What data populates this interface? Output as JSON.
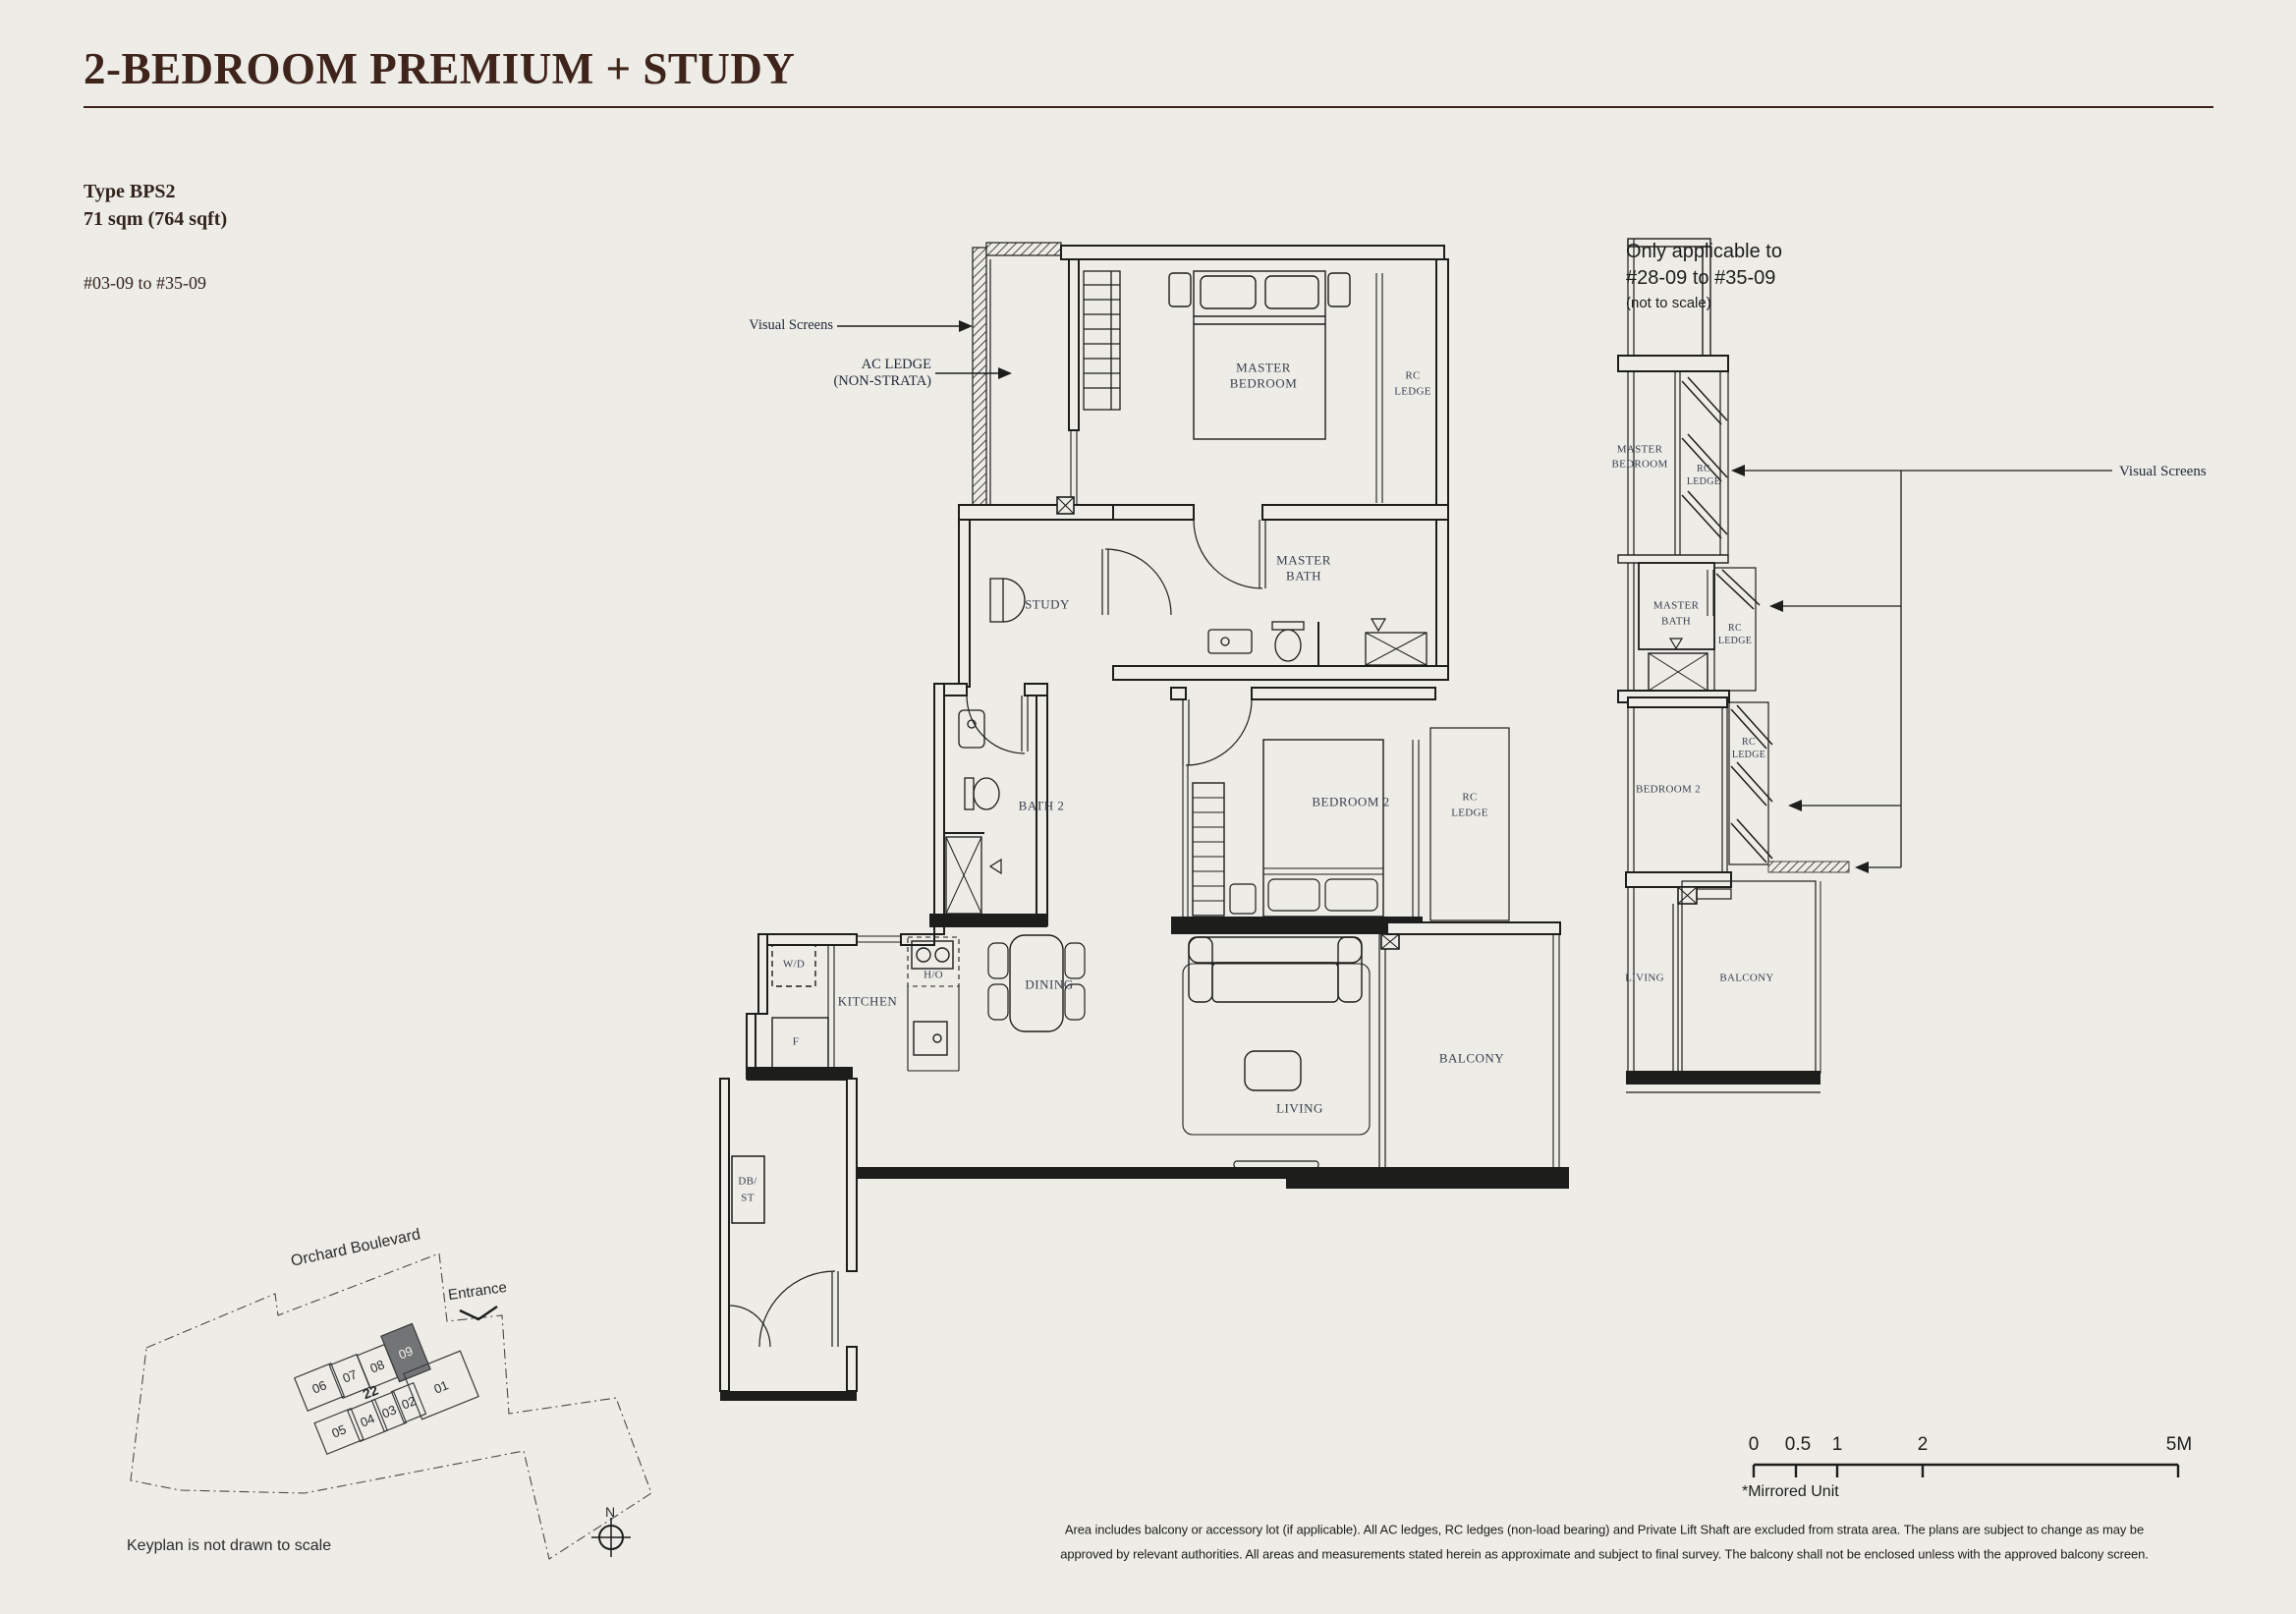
{
  "title": "2-BEDROOM PREMIUM + STUDY",
  "unit_info": {
    "type_label": "Type BPS2",
    "area": "71 sqm (764 sqft)",
    "stack_range": "#03-09 to #35-09"
  },
  "applicability": {
    "line1": "Only applicable to",
    "line2": "#28-09 to #35-09",
    "line3": "(not to scale)"
  },
  "callouts": {
    "visual_screens": "Visual Screens",
    "ac_ledge": "AC LEDGE",
    "ac_ledge_note": "(NON-STRATA)"
  },
  "rooms": {
    "master": "MASTER",
    "bedroom": "BEDROOM",
    "bath": "BATH",
    "rc": "RC",
    "ledge": "LEDGE",
    "study": "STUDY",
    "bath2": "BATH 2",
    "bedroom2": "BEDROOM 2",
    "wd": "W/D",
    "kitchen": "KITCHEN",
    "ho": "H/O",
    "fridge": "F",
    "dining": "DINING",
    "living": "LIVING",
    "balcony": "BALCONY",
    "db": "DB/",
    "st": "ST"
  },
  "keyplan": {
    "road": "Orchard Boulevard",
    "entrance": "Entrance",
    "north": "N",
    "note": "Keyplan is not drawn to scale",
    "units": {
      "u06": "06",
      "u07": "07",
      "u08": "08",
      "u09": "09",
      "u22": "22",
      "u01": "01",
      "u05": "05",
      "u04": "04",
      "u03": "03",
      "u02": "02"
    }
  },
  "scalebar": {
    "t0": "0",
    "t05": "0.5",
    "t1": "1",
    "t2": "2",
    "t5": "5M",
    "mirrored": "*Mirrored Unit"
  },
  "disclaimer": {
    "line1": "Area includes balcony or accessory lot (if applicable). All AC ledges, RC ledges (non-load bearing) and Private Lift Shaft are excluded from strata area. The plans are subject to change as may be",
    "line2": "approved by relevant authorities. All areas and measurements stated herein as approximate and subject to final survey. The balcony shall not be enclosed unless with the approved balcony screen."
  },
  "colors": {
    "background": "#edece7",
    "title": "#3f241b",
    "plan_line": "#1d1d1b",
    "room_label": "#39404d",
    "highlight_unit": "#737476"
  }
}
